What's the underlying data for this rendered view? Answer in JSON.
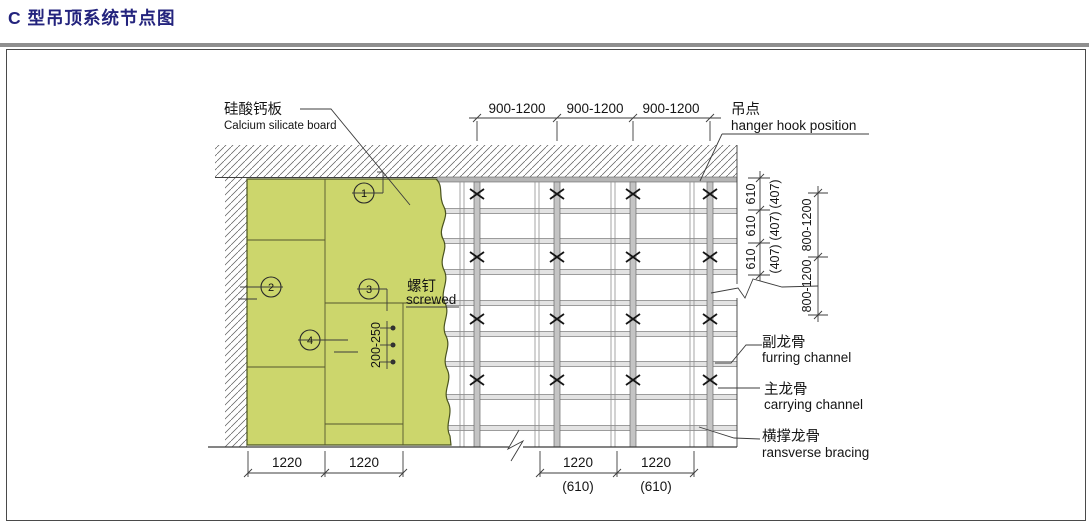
{
  "page": {
    "title": "C 型吊顶系统节点图"
  },
  "labels": {
    "board": {
      "zh": "硅酸钙板",
      "en": "Calcium silicate board"
    },
    "screw": {
      "zh": "螺钉",
      "en": "screwed"
    },
    "hanger": {
      "zh": "吊点",
      "en": "hanger hook position"
    },
    "furring": {
      "zh": "副龙骨",
      "en": "furring channel"
    },
    "carrying": {
      "zh": "主龙骨",
      "en": "carrying channel"
    },
    "bracing": {
      "zh": "横撑龙骨",
      "en": "ransverse bracing"
    }
  },
  "dims": {
    "top": [
      "900-1200",
      "900-1200",
      "900-1200"
    ],
    "bottom_left": [
      "1220",
      "1220"
    ],
    "bottom_right": [
      "1220",
      "1220"
    ],
    "bottom_right_alt": [
      "(610)",
      "(610)"
    ],
    "right_inner": [
      "610",
      "610",
      "610"
    ],
    "right_inner_alt": [
      "(407)",
      "(407)",
      "(407)"
    ],
    "right_outer": [
      "800-1200",
      "800-1200"
    ],
    "screw_spacing": "200-250"
  },
  "markers": [
    "1",
    "2",
    "3",
    "4"
  ],
  "colors": {
    "title_navy": "#23237d",
    "board_green": "#ccd66c",
    "channel_gray": "#c4c4c4"
  }
}
